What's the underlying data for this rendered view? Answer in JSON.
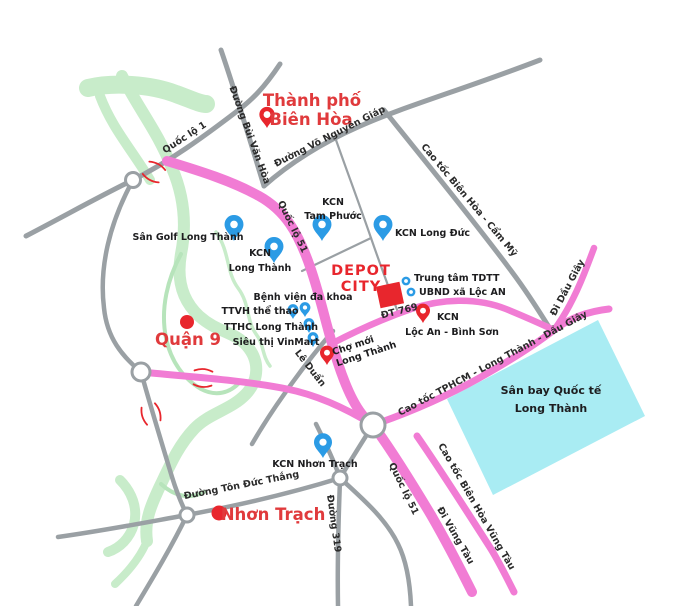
{
  "map": {
    "colors": {
      "road_major_pink": "#f17cd4",
      "road_minor_gray": "#9aa0a4",
      "river_green": "#c8ecca",
      "airport_cyan": "#a9ecf3",
      "accent_red": "#e8262d",
      "city_text_red": "#e03a3c",
      "pin_blue": "#2b9be5",
      "text_dark": "#1d1d1f",
      "background": "#ffffff"
    },
    "cities": {
      "bien_hoa_line1": "Thành phố",
      "bien_hoa_line2": "Biên Hòa",
      "quan_9": "Quận 9",
      "nhon_trach": "Nhơn Trạch"
    },
    "project": {
      "line1": "DEPOT",
      "line2": "CITY"
    },
    "roads": {
      "quoc_lo_1": "Quốc lộ 1",
      "duong_bui_van_hoa": "Đường Bùi Văn Hòa",
      "duong_vo_nguyen_giap": "Đường Võ Nguyên Giáp",
      "cao_toc_bien_hoa_cam_my": "Cao tốc Biên Hòa - Cẩm Mỹ",
      "quoc_lo_51_north": "Quốc lộ 51",
      "dt_769": "ĐT 769",
      "di_dau_giay": "Đi Dầu Giây",
      "cao_toc_tphcm": "Cao tốc TPHCM - Long Thành - Dầu Giây",
      "le_duan": "Lê Duẩn",
      "quoc_lo_51_south": "Quốc lộ 51",
      "di_vung_tau": "Đi Vũng Tàu",
      "cao_toc_bien_hoa_vung_tau": "Cao tốc Biên Hòa Vũng Tàu",
      "duong_319": "Đường 319",
      "duong_ton_duc_thang": "Đường Tôn Đức Thắng"
    },
    "pois": {
      "san_golf_long_thanh": "Sân Golf Long Thành",
      "kcn_long_thanh_line1": "KCN",
      "kcn_long_thanh_line2": "Long Thành",
      "kcn_tam_phuoc_line1": "KCN",
      "kcn_tam_phuoc_line2": "Tam Phước",
      "kcn_long_duc": "KCN Long Đức",
      "trung_tam_tdtt": "Trung tâm TDTT",
      "ubnd_xa_loc_an": "UBND xã Lộc AN",
      "kcn_loc_an_line1": "KCN",
      "kcn_loc_an_line2": "Lộc An - Bình Sơn",
      "benh_vien_da_khoa": "Bệnh viện đa khoa",
      "ttvh_the_thao": "TTVH thể thao",
      "tthc_long_thanh": "TTHC Long Thành",
      "sieu_thi_vinmart": "Siêu thị VinMart",
      "cho_moi_line1": "Chợ mới",
      "cho_moi_line2": "Long Thành",
      "kcn_nhon_trach": "KCN Nhơn Trạch"
    },
    "airport": {
      "line1": "Sân bay Quốc tế",
      "line2": "Long Thành"
    }
  }
}
